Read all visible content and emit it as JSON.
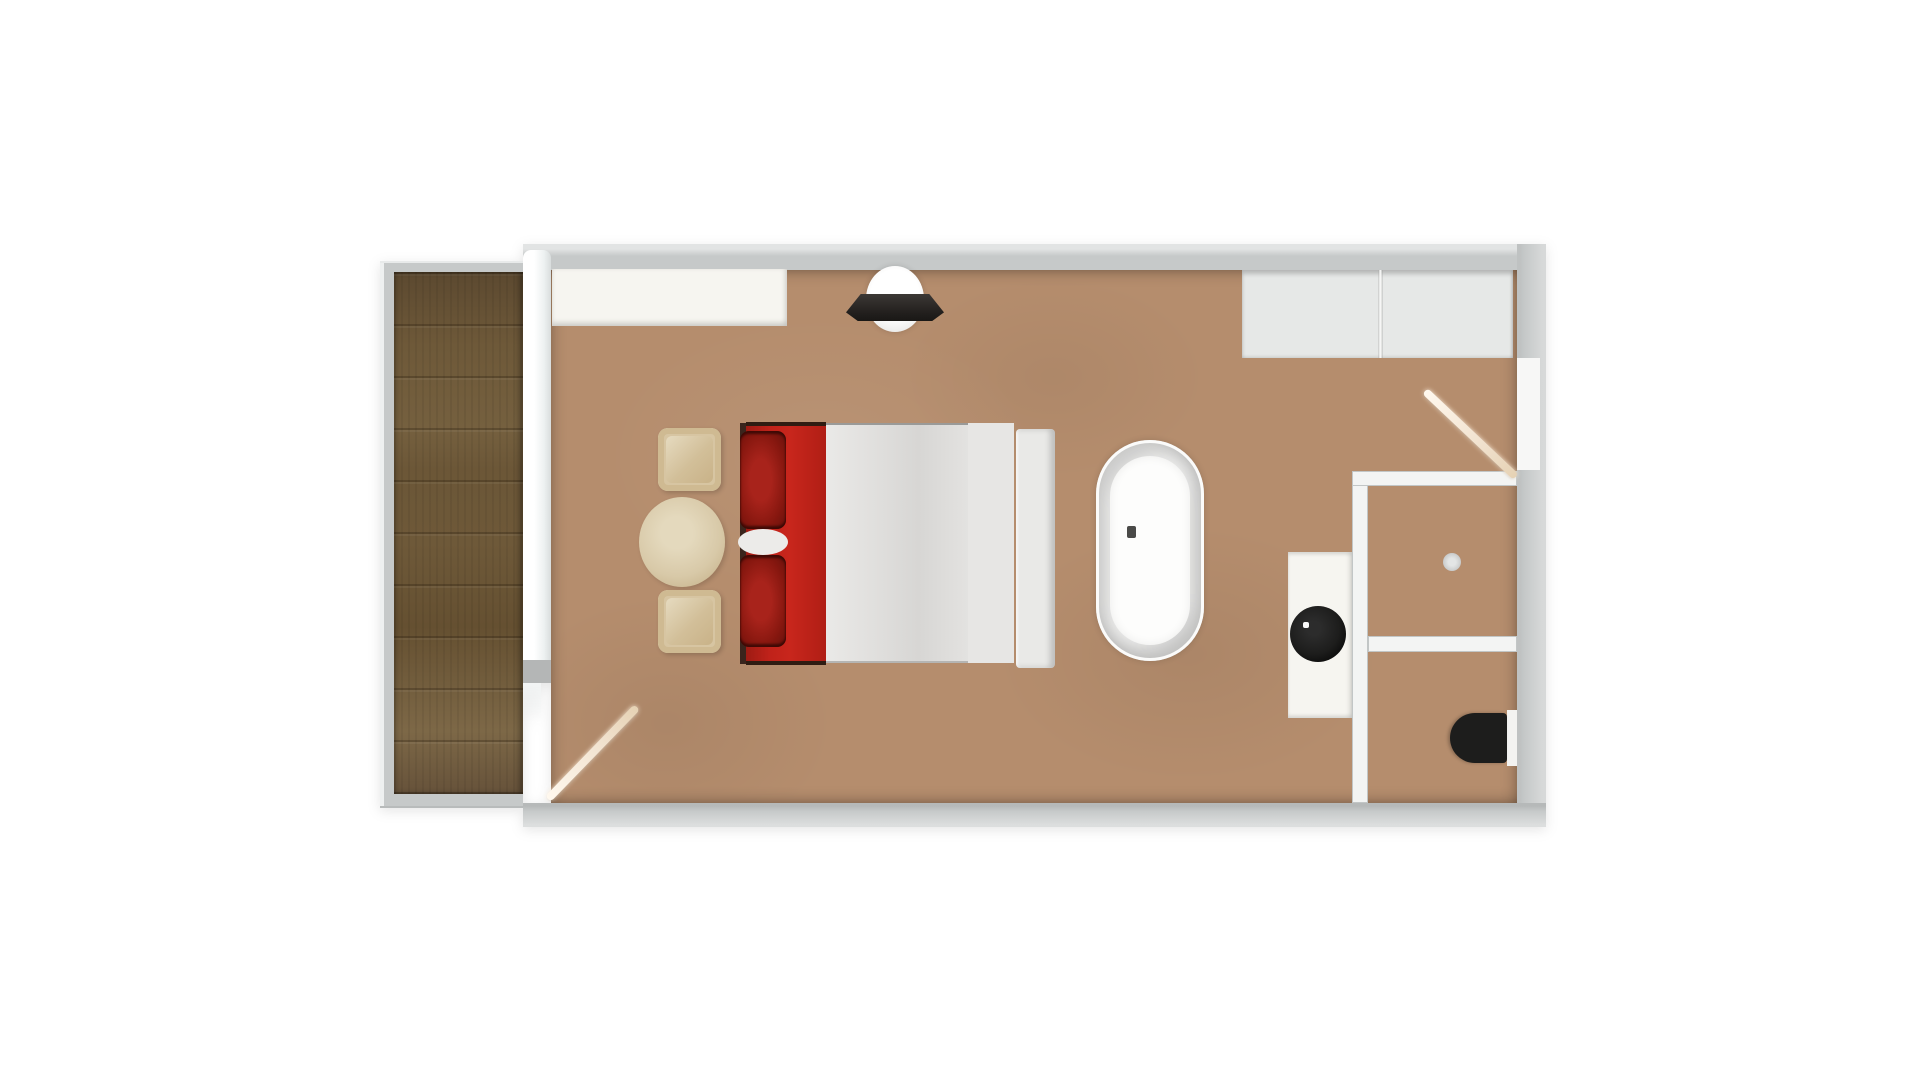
{
  "scene": {
    "type": "floor-plan-render",
    "view": "top-down",
    "rooms": [
      {
        "name": "balcony",
        "floor": "dark wood planks"
      },
      {
        "name": "bedroom",
        "floor": "tan"
      },
      {
        "name": "shower-room",
        "floor": "tan"
      },
      {
        "name": "wc",
        "floor": "tan"
      }
    ],
    "objects": [
      {
        "name": "wood-deck",
        "room": "balcony"
      },
      {
        "name": "balcony-door",
        "room": "bedroom",
        "state": "open"
      },
      {
        "name": "wardrobe-counter",
        "room": "bedroom"
      },
      {
        "name": "ceiling-lamp",
        "room": "bedroom"
      },
      {
        "name": "closet",
        "room": "bedroom",
        "sections": 2
      },
      {
        "name": "armchair",
        "room": "bedroom",
        "count": 2
      },
      {
        "name": "side-table",
        "room": "bedroom"
      },
      {
        "name": "double-bed",
        "room": "bedroom",
        "bedding": "red blanket, two dark-red pillows, white sheets, white headboard"
      },
      {
        "name": "freestanding-bathtub",
        "room": "bedroom"
      },
      {
        "name": "vanity-with-round-black-sink",
        "room": "bedroom"
      },
      {
        "name": "entry-door",
        "room": "bedroom",
        "state": "open"
      },
      {
        "name": "shower-drain",
        "room": "shower-room"
      },
      {
        "name": "toilet",
        "room": "wc"
      }
    ]
  },
  "palette": {
    "canvas_white": "#ffffff",
    "wall_gray": "#c6c9c9",
    "wall_cap_gray": "#b4b6b6",
    "floor_tan": "#b58d6d",
    "wood_dark": "#5c4930",
    "wood_mid": "#6e5939",
    "wood_light": "#7d6847",
    "counter_white": "#f6f5f0",
    "closet_gray": "#e6e8e7",
    "bed_red": "#c0221a",
    "bed_edge_dark": "#3a241c",
    "pillow_red": "#a8231b",
    "pillow_red_dark": "#6b120c",
    "sheet_white": "#e0dfdd",
    "headboard_white": "#e9e9e7",
    "chair_tan": "#d7c5a2",
    "chair_tan_dark": "#c9b288",
    "table_tan": "#d8c9a8",
    "tub_white": "#f1f1f0",
    "tub_inner_white": "#fdfdfc",
    "fixture_black": "#1d1d1c",
    "door_cream": "#f1e2cf",
    "drain_gray": "#c6c8c8"
  }
}
